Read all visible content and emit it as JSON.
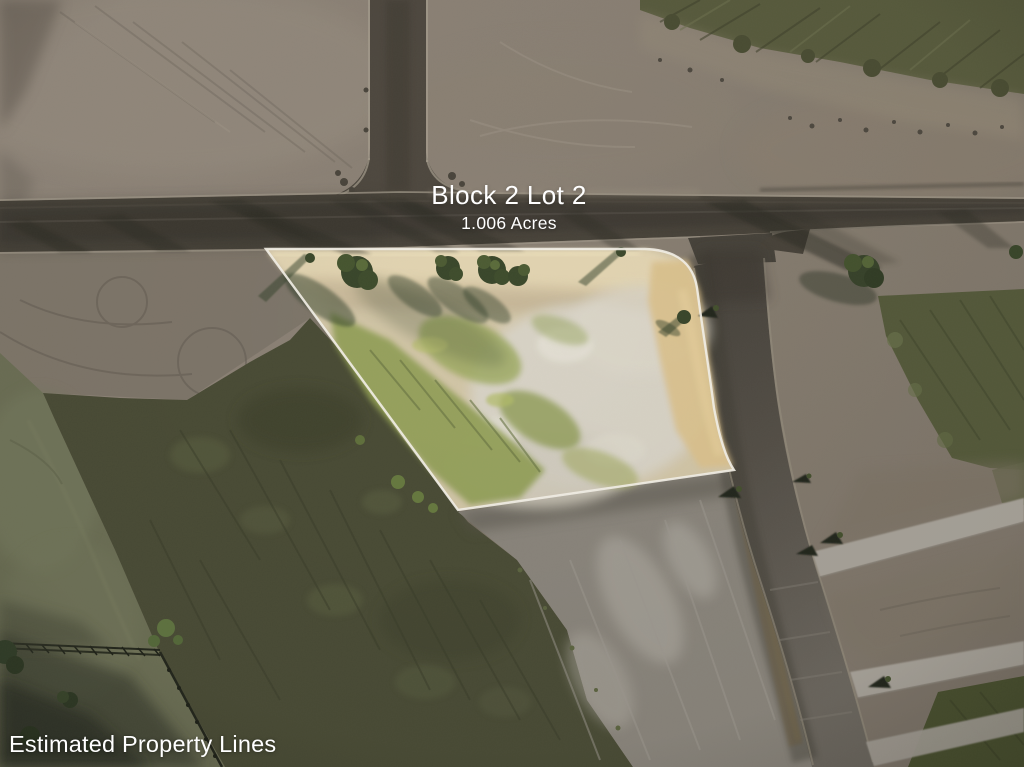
{
  "overlay": {
    "title": "Block 2 Lot 2",
    "subtitle": "1.006 Acres",
    "caption": "Estimated Property Lines"
  },
  "photo": {
    "description": "Aerial drone photo of a vacant 1.006 acre corner lot at a road T-intersection, property boundary highlighted in white",
    "property_line_color": "#F3F0E7",
    "text_color": "#FFFFFF",
    "palette": {
      "dirt_light": "#8E8478",
      "dirt_shaded": "#746B60",
      "asphalt": "#46423A",
      "asphalt_worn": "#6B665E",
      "concrete_street": "#A7A299",
      "scrub_green": "#494B35",
      "field_green": "#6B6E54",
      "hedge_green": "#585B3D",
      "lot_sand": "#E2D3AE",
      "lot_dry_grass": "#D6D1C4",
      "lot_grass": "#8E9B51",
      "tree_canopy": "#3E4A2C"
    }
  }
}
